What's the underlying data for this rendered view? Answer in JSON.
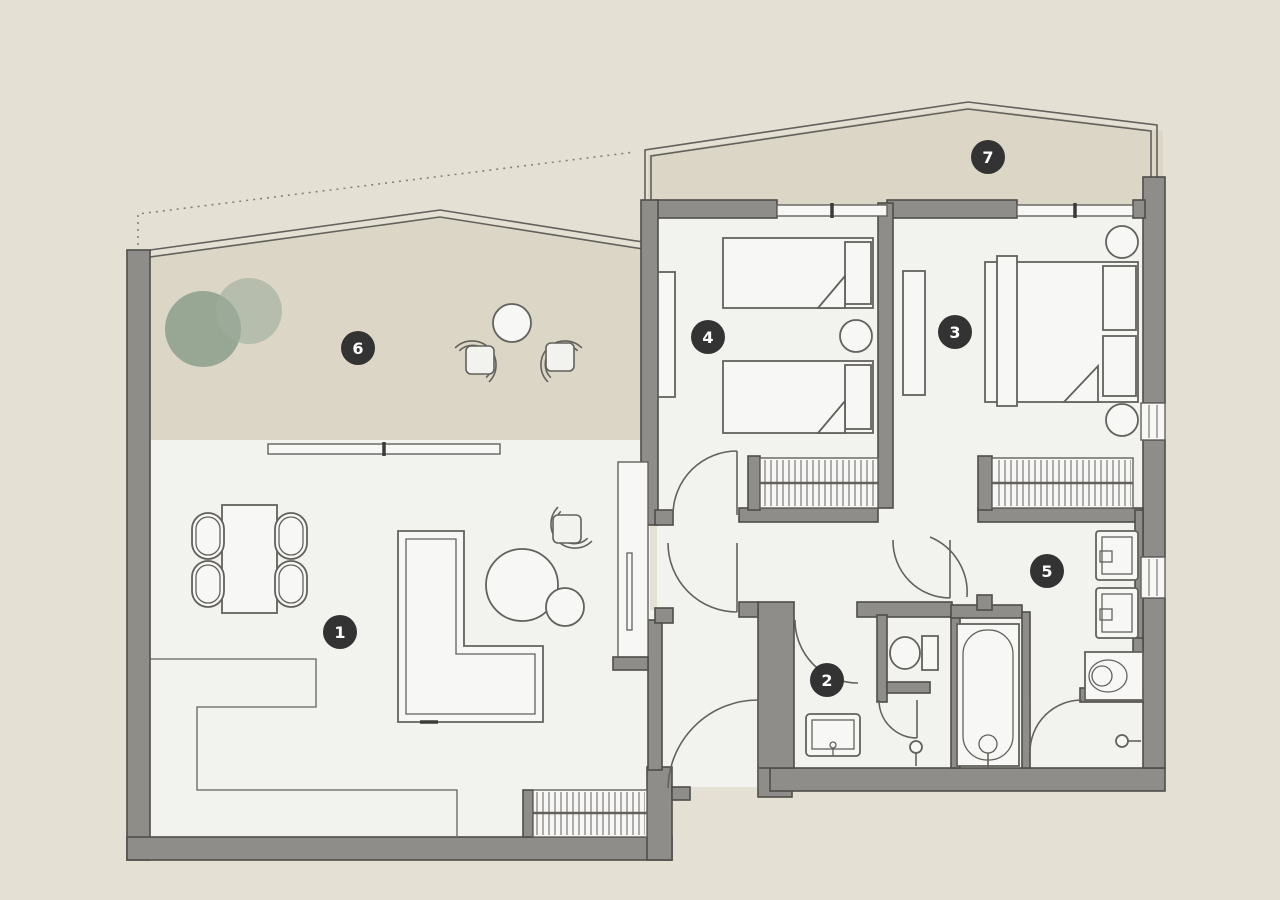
{
  "floorplan": {
    "rooms": [
      {
        "number": "1"
      },
      {
        "number": "2"
      },
      {
        "number": "3"
      },
      {
        "number": "4"
      },
      {
        "number": "5"
      },
      {
        "number": "6"
      },
      {
        "number": "7"
      }
    ],
    "colors": {
      "background": "#e4e0d4",
      "terrace_fill": "#dcd6c6",
      "interior_floor": "#f2f2ee",
      "wall_fill": "#8e8d89",
      "wall_outline": "#4f4d49",
      "furniture_line": "#63615c",
      "badge_fill": "#333333",
      "badge_text": "#ffffff",
      "plant_dark": "#7d9480",
      "plant_light": "#9fab9c"
    }
  }
}
